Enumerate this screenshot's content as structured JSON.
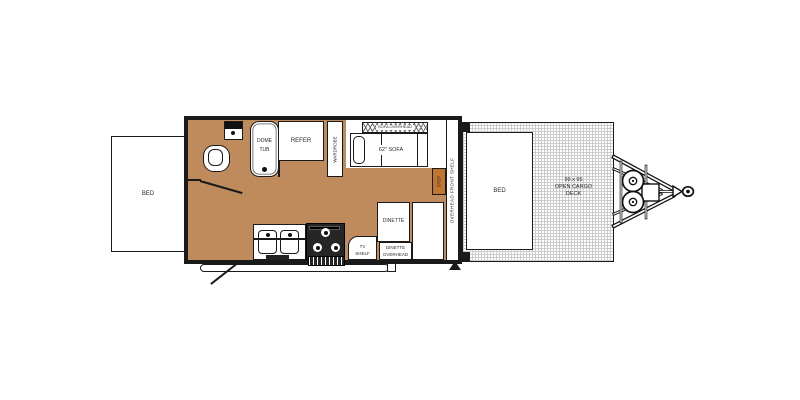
{
  "title": "Travel trailer floor plan with front open cargo deck",
  "colors": {
    "floor": "#BF8B5D",
    "step": "#C1762F",
    "wall": "#1A1A1A",
    "deck_grid": "#CCCCCC",
    "bg": "#FFFFFF",
    "ink": "#2A2A2A"
  },
  "labels": {
    "rear_bed": "BED",
    "dome_tub_l1": "DOME",
    "dome_tub_l2": "TUB",
    "refer": "REFER",
    "wardrobe": "WARDROBE",
    "sofa_overhead": "SOFA OVERHEAD",
    "sofa": "62\" SOFA",
    "step": "STEP",
    "front_shelf": "OVERHEAD  FRONT SHELF",
    "dinette": "DINETTE",
    "dinette_overhead_l1": "DINETTE",
    "dinette_overhead_l2": "OVERHEAD",
    "tv_shelf_l1": "TV",
    "tv_shelf_l2": "SHELF",
    "front_bed": "BED",
    "cargo_l1": "99 x 95",
    "cargo_l2": "OPEN CARGO",
    "cargo_l3": "DECK"
  }
}
